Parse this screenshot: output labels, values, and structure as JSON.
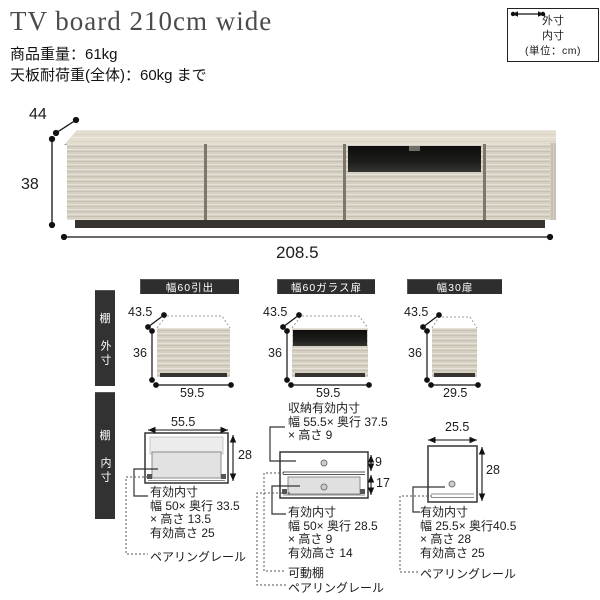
{
  "header": {
    "title": "TV board 210cm wide",
    "weight": "商品重量：61kg",
    "load": "天板耐荷重(全体)：60kg まで"
  },
  "legend": {
    "outer": "外寸",
    "inner": "内寸",
    "unit": "(単位：cm)"
  },
  "main_unit": {
    "depth": "44",
    "height": "38",
    "width": "208.5"
  },
  "side_bars": [
    {
      "group": "棚",
      "label": "外寸"
    },
    {
      "group": "棚",
      "label": "内寸"
    }
  ],
  "modules": [
    {
      "badge": "幅60引出",
      "outer": {
        "depth": "43.5",
        "height": "36",
        "width": "59.5"
      },
      "inner": {
        "width": "55.5",
        "height": "28",
        "notes": [
          "有効内寸",
          "幅 50× 奥行 33.5",
          "× 高さ 13.5",
          "有効高さ 25"
        ],
        "rail": "ペアリングレール"
      }
    },
    {
      "badge": "幅60ガラス扉",
      "outer": {
        "depth": "43.5",
        "height": "36",
        "width": "59.5"
      },
      "inner": {
        "storage_notes": [
          "収納有効内寸",
          "幅 55.5× 奥行 37.5",
          "× 高さ 9"
        ],
        "upper_height": "9",
        "lower_height": "17",
        "notes": [
          "有効内寸",
          "幅 50× 奥行 28.5",
          "× 高さ 9",
          "有効高さ 14"
        ],
        "shelf": "可動棚",
        "rail": "ペアリングレール"
      }
    },
    {
      "badge": "幅30扉",
      "outer": {
        "depth": "43.5",
        "height": "36",
        "width": "29.5"
      },
      "inner": {
        "width": "25.5",
        "height": "28",
        "notes": [
          "有効内寸",
          "幅 25.5× 奥行40.5",
          "× 高さ 28",
          "有効高さ 25"
        ],
        "rail": "ペアリングレール"
      }
    }
  ],
  "colors": {
    "wood": "#d6d0c3",
    "wood_top": "#e3ddcf",
    "base": "#37332f",
    "glass": "#161616",
    "badge_bg": "#2e2e2e",
    "text": "#1c1c1c"
  }
}
